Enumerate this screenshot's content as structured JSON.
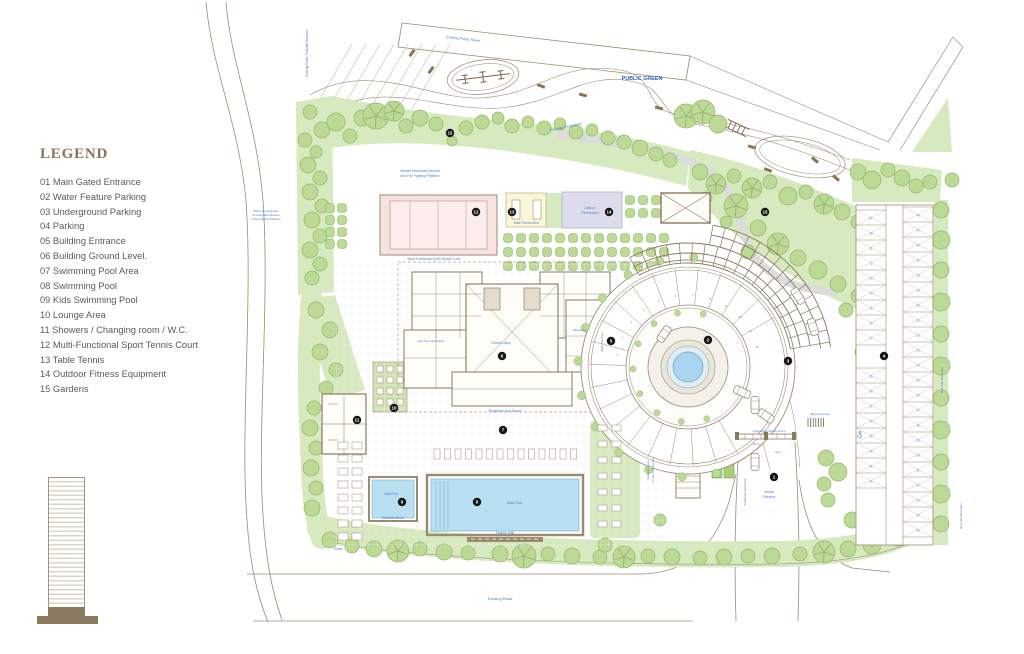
{
  "legend": {
    "title": "LEGEND",
    "items": [
      "01 Main Gated Entrance",
      "02 Water Feature Parking",
      "03 Underground Parking",
      "04 Parking",
      "05 Building Entrance",
      "06 Building Ground Level.",
      "07 Swimming Pool Area",
      "08 Swimming Pool",
      "09 Kids Swimming Pool",
      "10 Lounge Area",
      "11 Showers / Changing room / W.C.",
      "12 Multi-Functional Sport Tennis Court",
      "13 Table Tennis",
      "14 Outdoor Fitness Equipment",
      "15 Gardens"
    ]
  },
  "labels": {
    "public_green": "PUBLIC GREEN",
    "existing_public_street": "Existing Public Street",
    "existing_playground": "Existing Playground",
    "footpath_entrance": "Existing Public Footpath Entrance",
    "rescue_1": "Vehicle Articulated Rescue",
    "rescue_2": "and Fire Fighting Platform",
    "back_door_1": "Back Door Entrance",
    "back_door_2": "for Articulated Rescue",
    "back_door_3": "& Fire Fighting Platform",
    "court": "Multi-Functional Sport Tennis Court",
    "table_tennis": "Table Tennis Area",
    "fitness_1": "Outdoor",
    "fitness_2": "Fitness Area",
    "grand_lobby": "Grand Lobby",
    "reception": "Reception",
    "spa_reception": "Spa Area Reception",
    "main_entrance": "Main Entrance",
    "projection_line": "Projection Line Above",
    "main_pool": "Main Pool",
    "kids_pool": "Kids Pool",
    "umbrella_above": "Umbrella Above",
    "feature_wall": "Feature Wall",
    "grass": "Grass",
    "cabanas_1": "Cabanas Area",
    "cabanas_2": "for the 3 bedrooms",
    "operable_doors": "Operable Entrance Doors",
    "entry": "Entry",
    "exit": "Exit",
    "vehicle_1": "Vehicle",
    "vehicle_2": "Entrance",
    "pedestrian": "Pedestrian Entrance",
    "bicycles": "Bicycles Area",
    "new_plot_boundary": "New Plot Boundary",
    "existing_road": "Existing Road"
  },
  "markers": [
    {
      "n": "1",
      "x": 774,
      "y": 477
    },
    {
      "n": "2",
      "x": 708,
      "y": 340
    },
    {
      "n": "3",
      "x": 788,
      "y": 361
    },
    {
      "n": "4",
      "x": 884,
      "y": 356
    },
    {
      "n": "5",
      "x": 611,
      "y": 341
    },
    {
      "n": "6",
      "x": 502,
      "y": 356
    },
    {
      "n": "7",
      "x": 503,
      "y": 430
    },
    {
      "n": "8",
      "x": 477,
      "y": 502
    },
    {
      "n": "9",
      "x": 402,
      "y": 502
    },
    {
      "n": "10",
      "x": 394,
      "y": 408
    },
    {
      "n": "11",
      "x": 357,
      "y": 420
    },
    {
      "n": "12",
      "x": 476,
      "y": 212
    },
    {
      "n": "13",
      "x": 512,
      "y": 212
    },
    {
      "n": "14",
      "x": 609,
      "y": 212
    },
    {
      "n": "15",
      "x": 450,
      "y": 133
    },
    {
      "n": "15",
      "x": 765,
      "y": 212
    }
  ],
  "parking": {
    "right_lot_left_upper": [
      "57",
      "58",
      "11",
      "12",
      "13",
      "14",
      "15",
      "16",
      "17"
    ],
    "right_lot_left_lower": [
      "35",
      "36",
      "37",
      "38",
      "39",
      "40",
      "41",
      "42"
    ],
    "right_lot_right": [
      "46",
      "45",
      "44",
      "43",
      "18",
      "19",
      "20",
      "21",
      "22",
      "23",
      "24",
      "25",
      "26",
      "27",
      "28",
      "29",
      "30",
      "51",
      "52",
      "53",
      "54",
      "55"
    ],
    "circle_numbers": [
      "1",
      "2",
      "3",
      "4",
      "5",
      "6",
      "7",
      "8",
      "9",
      "10",
      "11",
      "12"
    ]
  },
  "colors": {
    "garden_green": "#d7e9be",
    "tree_green": "#bcd996",
    "tree_outline": "#8fb868",
    "court_pink": "#f7e2e0",
    "table_tennis_yellow": "#faf6da",
    "fitness_lavender": "#dcdcec",
    "pool_blue": "#b9e0f2",
    "path_gray": "#dcdcdc",
    "plan_line_brown": "#9b8b72",
    "label_blue": "#4a7fc1",
    "marker_black": "#161616"
  }
}
